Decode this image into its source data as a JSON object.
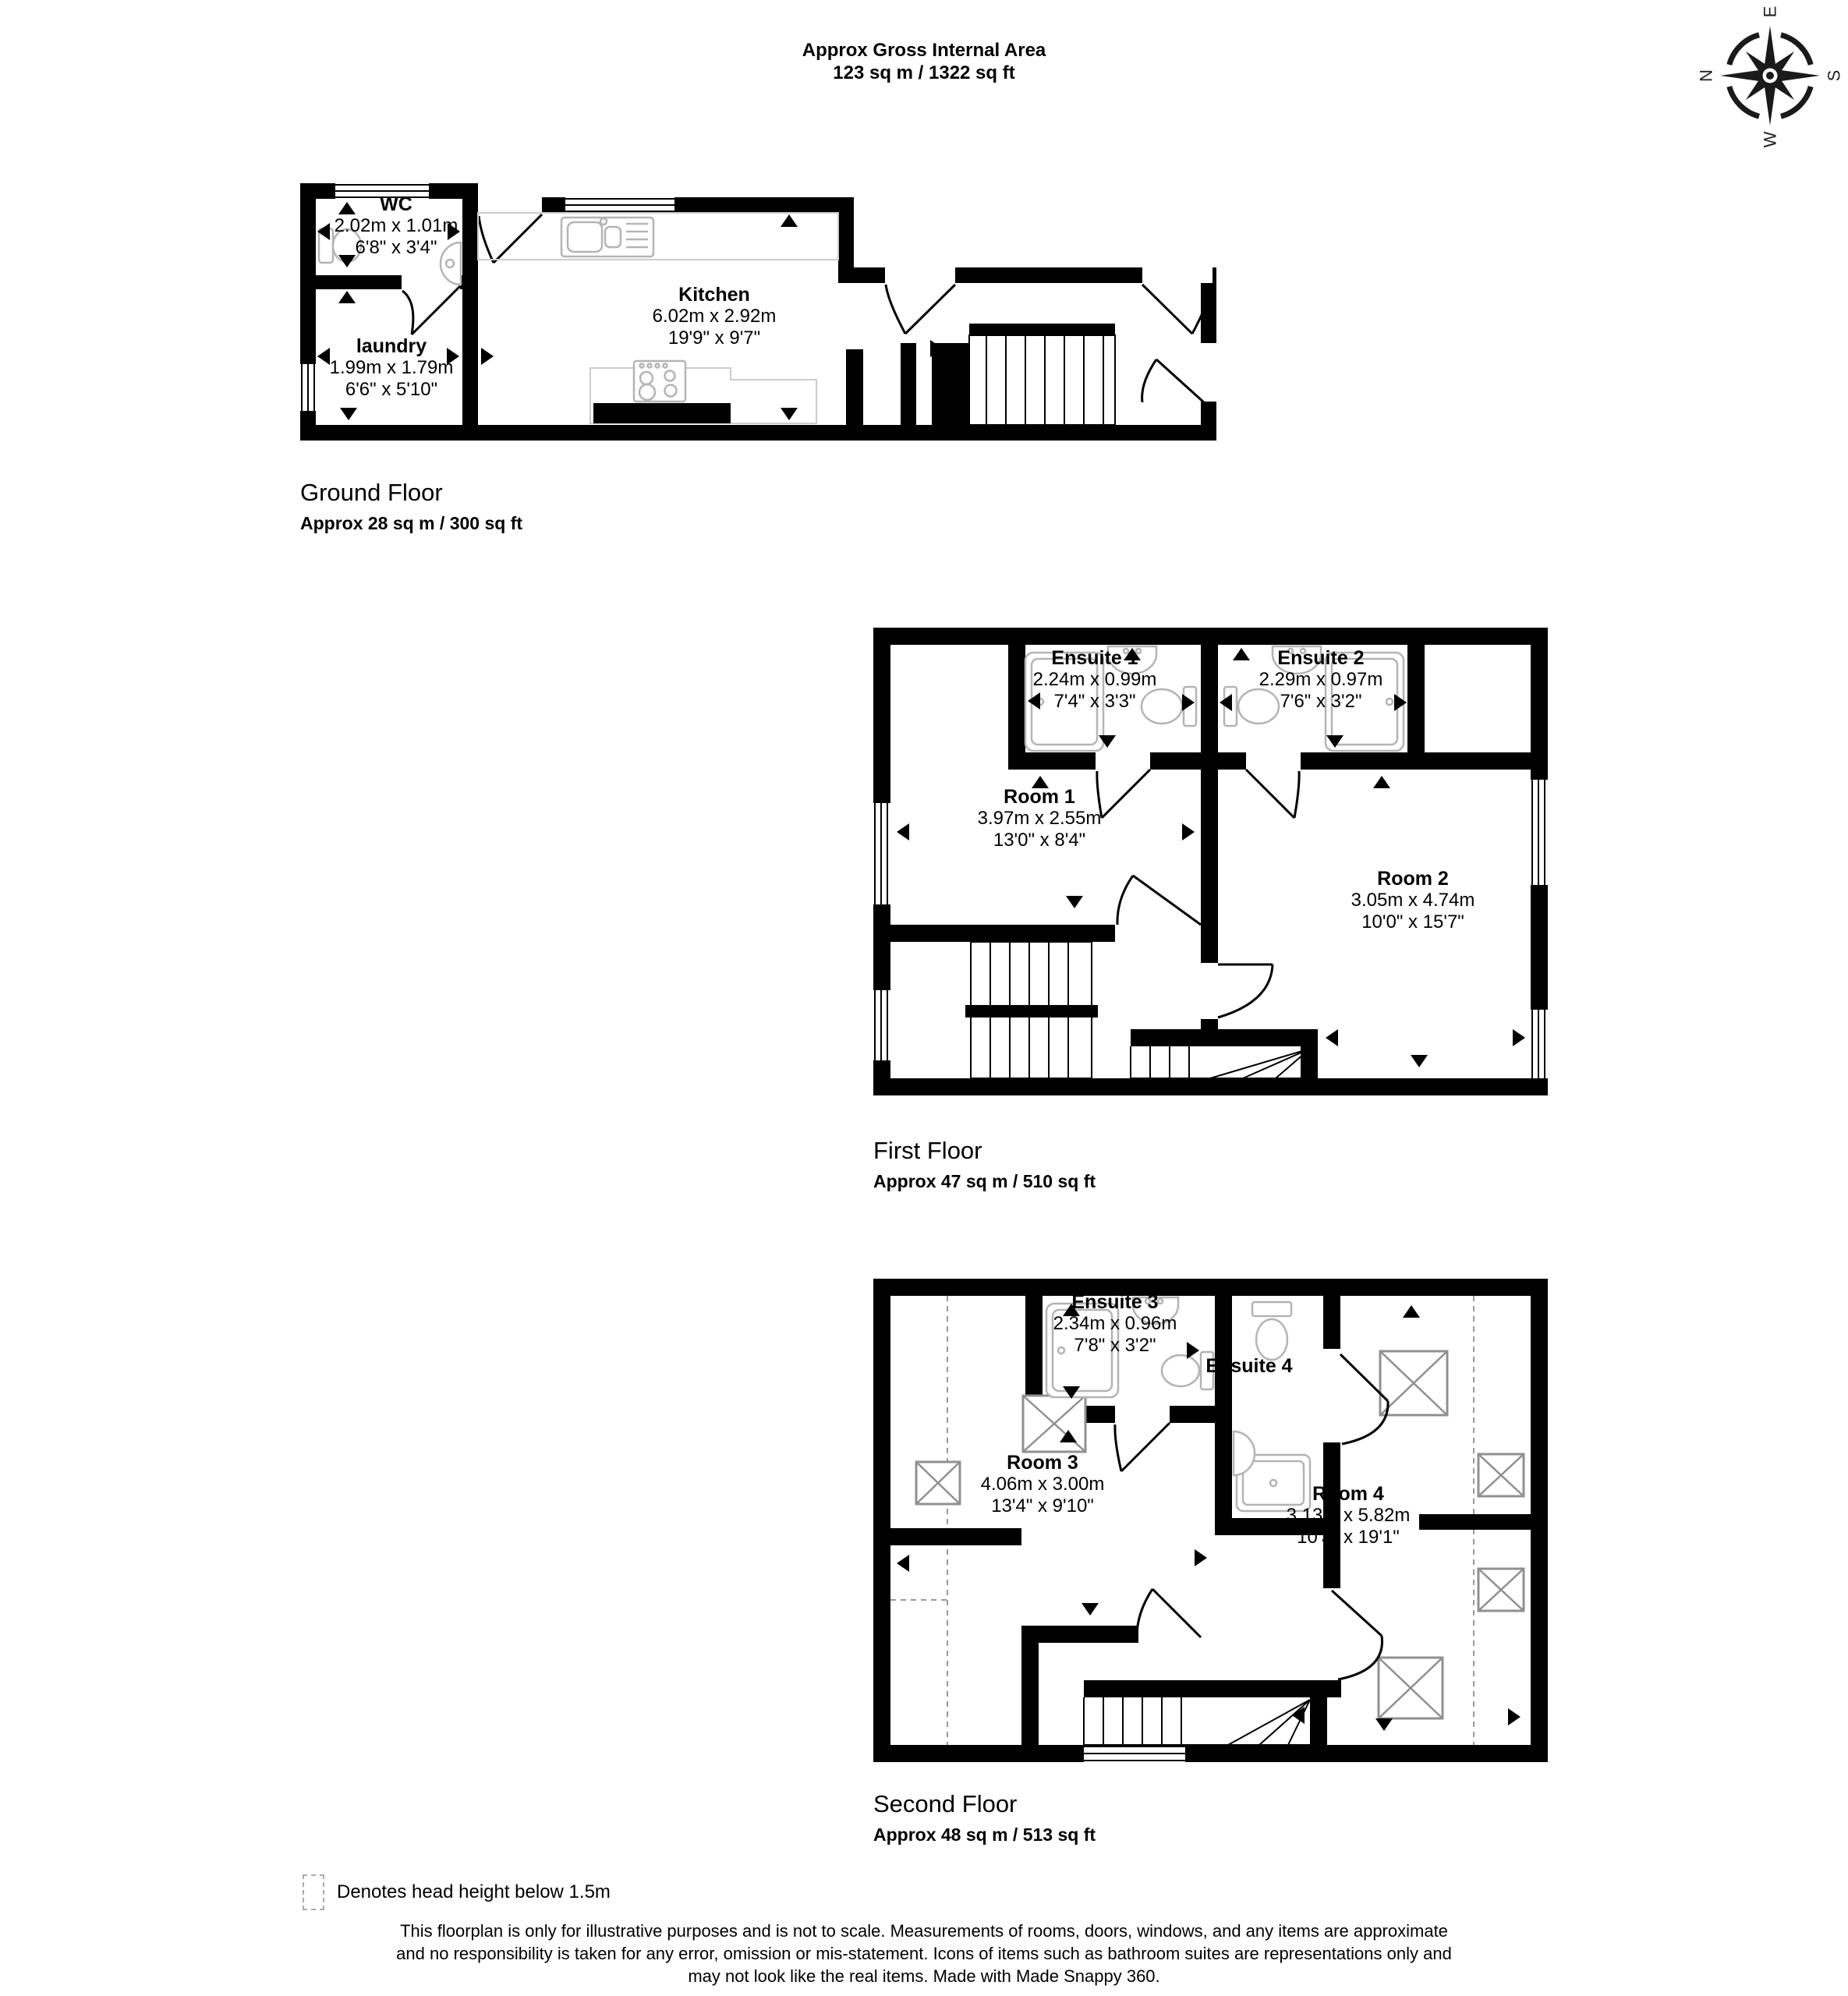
{
  "header": {
    "title_line1": "Approx Gross Internal Area",
    "title_line2": "123 sq m / 1322 sq ft"
  },
  "compass": {
    "n": "N",
    "e": "E",
    "s": "S",
    "w": "W"
  },
  "floors": [
    {
      "name": "Ground Floor",
      "area": "Approx 28 sq m / 300 sq ft",
      "rooms": [
        {
          "label": "WC",
          "dim_m": "2.02m x 1.01m",
          "dim_ft": "6'8\" x 3'4\""
        },
        {
          "label": "laundry",
          "dim_m": "1.99m x 1.79m",
          "dim_ft": "6'6\" x 5'10\""
        },
        {
          "label": "Kitchen",
          "dim_m": "6.02m x 2.92m",
          "dim_ft": "19'9\" x 9'7\""
        }
      ]
    },
    {
      "name": "First Floor",
      "area": "Approx 47 sq m / 510 sq ft",
      "rooms": [
        {
          "label": "Ensuite 1",
          "dim_m": "2.24m x 0.99m",
          "dim_ft": "7'4\" x 3'3\""
        },
        {
          "label": "Ensuite 2",
          "dim_m": "2.29m x 0.97m",
          "dim_ft": "7'6\" x 3'2\""
        },
        {
          "label": "Room 1",
          "dim_m": "3.97m x 2.55m",
          "dim_ft": "13'0\" x 8'4\""
        },
        {
          "label": "Room 2",
          "dim_m": "3.05m x 4.74m",
          "dim_ft": "10'0\" x 15'7\""
        }
      ]
    },
    {
      "name": "Second Floor",
      "area": "Approx 48 sq m / 513 sq ft",
      "rooms": [
        {
          "label": "Ensuite 3",
          "dim_m": "2.34m x 0.96m",
          "dim_ft": "7'8\" x 3'2\""
        },
        {
          "label": "Ensuite 4",
          "dim_m": "",
          "dim_ft": ""
        },
        {
          "label": "Room 3",
          "dim_m": "4.06m x 3.00m",
          "dim_ft": "13'4\" x 9'10\""
        },
        {
          "label": "Room 4",
          "dim_m": "3.13m x 5.82m",
          "dim_ft": "10'3\" x 19'1\""
        }
      ]
    }
  ],
  "legend": {
    "text": "Denotes head height below 1.5m"
  },
  "disclaimer": {
    "line1": "This floorplan is only for illustrative purposes and is not to scale. Measurements of rooms, doors, windows, and any items are approximate",
    "line2": "and no responsibility is taken for any error, omission or mis-statement. Icons of items such as bathroom suites are representations only and",
    "line3": "may not look like the real items. Made with Made Snappy 360."
  }
}
